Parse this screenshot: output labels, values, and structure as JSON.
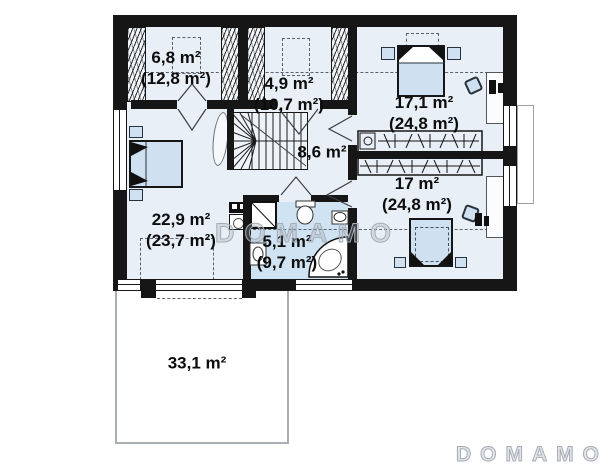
{
  "plan": {
    "floor_name": "upper-floor-plan",
    "rooms": [
      {
        "id": "wardrobe-left",
        "area": "6,8 m²",
        "total": "(12,8 m²)"
      },
      {
        "id": "wardrobe-middle",
        "area": "4,9 m²",
        "total": "(10,7 m²)"
      },
      {
        "id": "bedroom-top-right",
        "area": "17,1 m²",
        "total": "(24,8 m²)"
      },
      {
        "id": "hallway",
        "area": "8,6 m²",
        "total": ""
      },
      {
        "id": "bedroom-bottom-right",
        "area": "17 m²",
        "total": "(24,8 m²)"
      },
      {
        "id": "bedroom-left",
        "area": "22,9 m²",
        "total": "(23,7 m²)"
      },
      {
        "id": "bathroom",
        "area": "5,1 m²",
        "total": "(9,7 m²)"
      },
      {
        "id": "terrace",
        "area": "33,1 m²",
        "total": ""
      }
    ],
    "branding": {
      "watermark": "DOMAMO",
      "logo": "DOMAMO"
    },
    "colors": {
      "wall": "#161616",
      "room_fill": "#e9eff6",
      "bathroom_fill": "#cfe3f2",
      "furniture_fill": "#cfe1f1",
      "dashed_line": "#57606b",
      "watermark_gray": "#a7adb7"
    }
  }
}
